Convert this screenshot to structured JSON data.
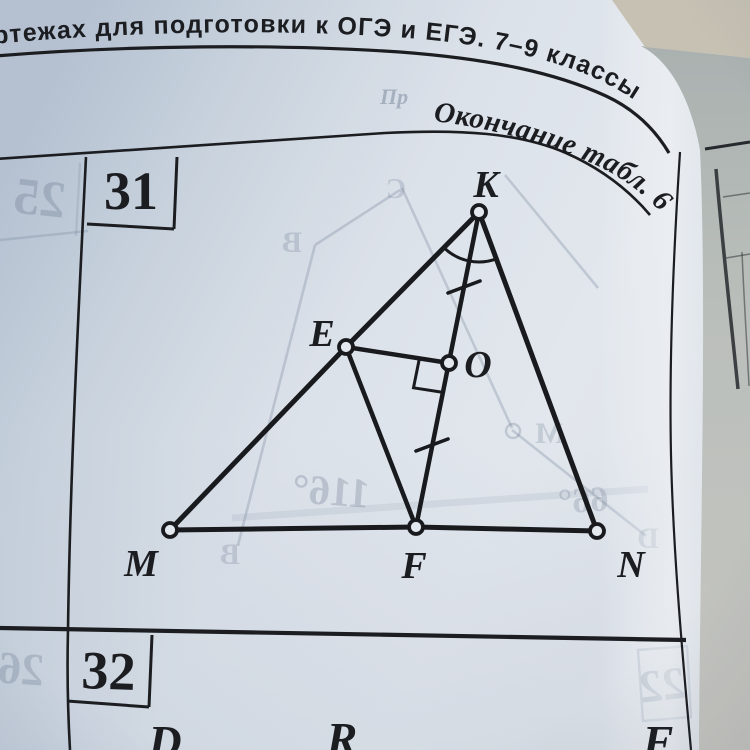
{
  "book": {
    "running_head": "ртежах для подготовки к ОГЭ и ЕГЭ. 7–9 классы",
    "table_note": "Окончание табл. 6"
  },
  "problems": {
    "current_number": "31",
    "next_number": "32"
  },
  "figure31": {
    "labels": {
      "K": "K",
      "E": "E",
      "O": "O",
      "M": "M",
      "F": "F",
      "N": "N"
    }
  },
  "figure32_partial": {
    "labels": [
      "D",
      "R",
      "F"
    ]
  },
  "print_through": {
    "left_box": "25",
    "bottom_left_box": "26",
    "bottom_right_box": "22",
    "angle_1": "116°",
    "angle_2": "66°",
    "letter_b_top": "B",
    "letter_c": "C",
    "letter_m": "M",
    "letter_b_bottom": "B",
    "letter_d": "D",
    "partial_word": "Пр"
  },
  "colors": {
    "ink": "#1a1b1e",
    "paper": "#e7ebf0",
    "ghost": "#6d7b92",
    "background_tan": "#ccc5b5"
  }
}
